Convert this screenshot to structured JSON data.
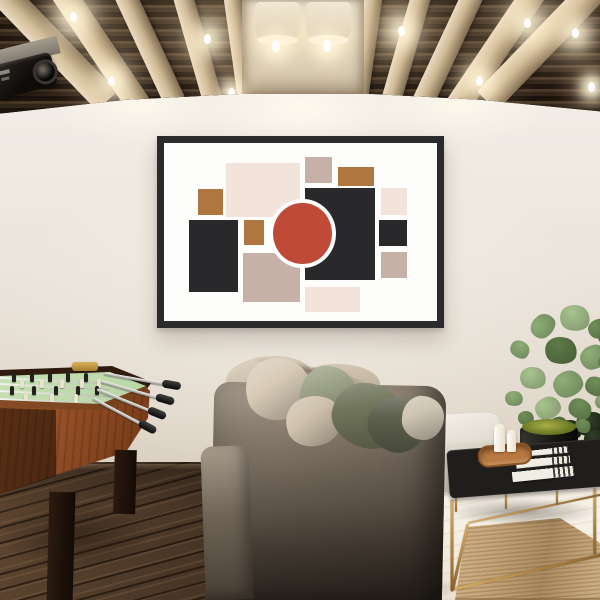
{
  "meta": {
    "title": "Game room interior: abstract geometric framed art print above a sofa, coffered ceiling with exposed bulbs, foosball table, plant, ottoman and tufted bench"
  },
  "labels": {
    "ceiling": "coffered wood ceiling",
    "projector": "ceiling-mounted projector",
    "artwork": "framed abstract geometric art print",
    "foosball": "wooden foosball table",
    "sofa": "fabric sofa with pillows",
    "console": "white console shelf with books",
    "ottoman": "white ottoman",
    "plant": "potted plant",
    "bench": "black tufted bench with gold frame",
    "books": "stack of books",
    "tray": "wooden tray with candles",
    "rug": "striped area rug"
  },
  "colors": {
    "wall": "#ece6de",
    "floor_dark": "#453324",
    "floor_light": "#f3eee4",
    "ceiling_base": "#2b2118",
    "ceiling_beam": "#d4c3a4",
    "gold": "#b8894a",
    "bench_leather": "#201e1c",
    "rug_base": "#c4a377"
  },
  "ceiling": {
    "beams": [
      {
        "x": -18,
        "rot": -44,
        "w": 28
      },
      {
        "x": 46,
        "rot": -34,
        "w": 25
      },
      {
        "x": 110,
        "rot": -25,
        "w": 22
      },
      {
        "x": 170,
        "rot": -16,
        "w": 20
      },
      {
        "x": 222,
        "rot": -8,
        "w": 18
      },
      {
        "x": 366,
        "rot": 8,
        "w": 18
      },
      {
        "x": 414,
        "rot": 16,
        "w": 20
      },
      {
        "x": 466,
        "rot": 25,
        "w": 22
      },
      {
        "x": 526,
        "rot": 34,
        "w": 25
      },
      {
        "x": 584,
        "rot": 44,
        "w": 28
      }
    ],
    "bulbs": [
      {
        "x": 70,
        "y": 12,
        "s": 15
      },
      {
        "x": 108,
        "y": 76,
        "s": 12
      },
      {
        "x": 204,
        "y": 34,
        "s": 12
      },
      {
        "x": 228,
        "y": 88,
        "s": 8
      },
      {
        "x": 398,
        "y": 26,
        "s": 12
      },
      {
        "x": 476,
        "y": 76,
        "s": 11
      },
      {
        "x": 524,
        "y": 18,
        "s": 14
      },
      {
        "x": 572,
        "y": 28,
        "s": 12
      },
      {
        "x": 588,
        "y": 82,
        "s": 8
      }
    ],
    "drums": [
      {
        "x": 13
      },
      {
        "x": 64
      }
    ]
  },
  "artwork": {
    "palette": {
      "beige": "#f2e4db",
      "taupe": "#c5b1a7",
      "brown": "#b0763f",
      "black": "#29282b",
      "red": "#c04a38"
    },
    "shapes": [
      {
        "name": "beige-large-rect",
        "color": "beige",
        "x": 22.8,
        "y": 11.0,
        "w": 27.2,
        "h": 30.6
      },
      {
        "name": "taupe-top-square",
        "color": "taupe",
        "x": 51.5,
        "y": 8.1,
        "w": 9.9,
        "h": 14.5
      },
      {
        "name": "brown-top-right",
        "color": "brown",
        "x": 63.6,
        "y": 13.3,
        "w": 13.2,
        "h": 11.0
      },
      {
        "name": "brown-left-square",
        "color": "brown",
        "x": 12.5,
        "y": 26.0,
        "w": 9.2,
        "h": 14.5
      },
      {
        "name": "black-center-rect",
        "color": "black",
        "x": 51.5,
        "y": 25.4,
        "w": 25.7,
        "h": 51.4
      },
      {
        "name": "beige-right-square",
        "color": "beige",
        "x": 79.4,
        "y": 25.4,
        "w": 9.6,
        "h": 15.0
      },
      {
        "name": "black-left-rect",
        "color": "black",
        "x": 9.2,
        "y": 43.4,
        "w": 18.0,
        "h": 40.5
      },
      {
        "name": "brown-center-square",
        "color": "brown",
        "x": 29.4,
        "y": 43.4,
        "w": 7.4,
        "h": 13.9
      },
      {
        "name": "black-right-square",
        "color": "black",
        "x": 78.7,
        "y": 43.4,
        "w": 10.3,
        "h": 14.5
      },
      {
        "name": "taupe-right-square",
        "color": "taupe",
        "x": 79.4,
        "y": 61.3,
        "w": 9.6,
        "h": 14.5
      },
      {
        "name": "taupe-bottom-square",
        "color": "taupe",
        "x": 29.0,
        "y": 61.8,
        "w": 21.0,
        "h": 27.7
      },
      {
        "name": "beige-bottom-rect",
        "color": "beige",
        "x": 51.8,
        "y": 80.9,
        "w": 19.9,
        "h": 13.9
      }
    ],
    "circle": {
      "name": "red-circle",
      "color": "red",
      "cx": 50.7,
      "cy": 50.9,
      "d": 24.3
    }
  },
  "foosball": {
    "player_rows": [
      {
        "y": 13,
        "c": "#23211e",
        "xs": [
          12,
          30,
          48,
          66,
          84
        ]
      },
      {
        "y": 19,
        "c": "#e9e3cf",
        "xs": [
          20,
          40,
          60,
          80,
          97
        ]
      },
      {
        "y": 26,
        "c": "#23211e",
        "xs": [
          10,
          32,
          54,
          76,
          95
        ]
      },
      {
        "y": 34,
        "c": "#e9e3cf",
        "xs": [
          24,
          50,
          74
        ]
      }
    ],
    "rods": [
      {
        "x": 104,
        "y": 12,
        "len": 62,
        "rot": 10
      },
      {
        "x": 101,
        "y": 20,
        "len": 60,
        "rot": 16
      },
      {
        "x": 97,
        "y": 28,
        "len": 58,
        "rot": 22
      },
      {
        "x": 93,
        "y": 37,
        "len": 55,
        "rot": 28
      }
    ]
  },
  "sofa": {
    "pillows": [
      {
        "name": "beige-pillow-left",
        "x": 246,
        "y": 358,
        "w": 64,
        "h": 62,
        "rot": -10,
        "c": "#d8cbb7"
      },
      {
        "name": "sage-pillow",
        "x": 300,
        "y": 366,
        "w": 56,
        "h": 60,
        "rot": 8,
        "c": "#9aa083"
      },
      {
        "name": "beige-pillow-front",
        "x": 286,
        "y": 396,
        "w": 56,
        "h": 50,
        "rot": -14,
        "c": "#cfc2ac"
      },
      {
        "name": "olive-pillow",
        "x": 332,
        "y": 384,
        "w": 74,
        "h": 64,
        "rot": 18,
        "c": "#707459"
      },
      {
        "name": "dark-olive-pillow",
        "x": 368,
        "y": 398,
        "w": 58,
        "h": 54,
        "rot": 26,
        "c": "#5c604d"
      },
      {
        "name": "beige-pillow-right",
        "x": 402,
        "y": 396,
        "w": 42,
        "h": 44,
        "rot": 6,
        "c": "#cdc3b1"
      }
    ]
  },
  "plant": {
    "greens": [
      "#6f8f58",
      "#8fae77",
      "#a9c48f",
      "#5d7a47"
    ],
    "leaves": [
      [
        35,
        20,
        26,
        1
      ],
      [
        65,
        10,
        30,
        2
      ],
      [
        93,
        24,
        22,
        0
      ],
      [
        15,
        46,
        20,
        1
      ],
      [
        50,
        42,
        32,
        3
      ],
      [
        85,
        50,
        28,
        1
      ],
      [
        103,
        60,
        18,
        0
      ],
      [
        25,
        72,
        26,
        2
      ],
      [
        58,
        76,
        30,
        1
      ],
      [
        90,
        82,
        22,
        0
      ],
      [
        10,
        96,
        18,
        1
      ],
      [
        40,
        102,
        26,
        2
      ],
      [
        73,
        104,
        24,
        0
      ],
      [
        100,
        100,
        16,
        1
      ],
      [
        53,
        122,
        20,
        3
      ],
      [
        80,
        124,
        16,
        0
      ],
      [
        23,
        116,
        16,
        0
      ],
      [
        103,
        35,
        16,
        3
      ]
    ],
    "dark_leaves": [
      [
        0,
        8,
        26
      ],
      [
        20,
        0,
        30
      ],
      [
        28,
        18,
        22
      ]
    ]
  },
  "bench": {
    "rails": [
      {
        "x": 12,
        "y": 68,
        "len": 92,
        "rot": 90,
        "w": 3
      },
      {
        "x": 155,
        "y": 57,
        "len": 66,
        "rot": 90,
        "w": 2.5
      },
      {
        "x": 12,
        "y": 158,
        "len": 160,
        "rot": -13,
        "w": 3
      },
      {
        "x": 28,
        "y": 93,
        "len": 68,
        "rot": 103,
        "w": 2.5
      },
      {
        "x": 28,
        "y": 92,
        "len": 138,
        "rot": -12,
        "w": 2
      },
      {
        "x": 16,
        "y": 66,
        "len": 15,
        "rot": 90,
        "w": 2
      },
      {
        "x": 66,
        "y": 62,
        "len": 16,
        "rot": 90,
        "w": 2
      },
      {
        "x": 117,
        "y": 58,
        "len": 16,
        "rot": 90,
        "w": 2
      }
    ]
  },
  "books": [
    {
      "x": 12,
      "y": 2,
      "w": 46,
      "h": 10,
      "rot": -7
    },
    {
      "x": 6,
      "y": 11,
      "w": 54,
      "h": 12,
      "rot": -5
    },
    {
      "x": 2,
      "y": 22,
      "w": 62,
      "h": 13,
      "rot": -6
    }
  ]
}
